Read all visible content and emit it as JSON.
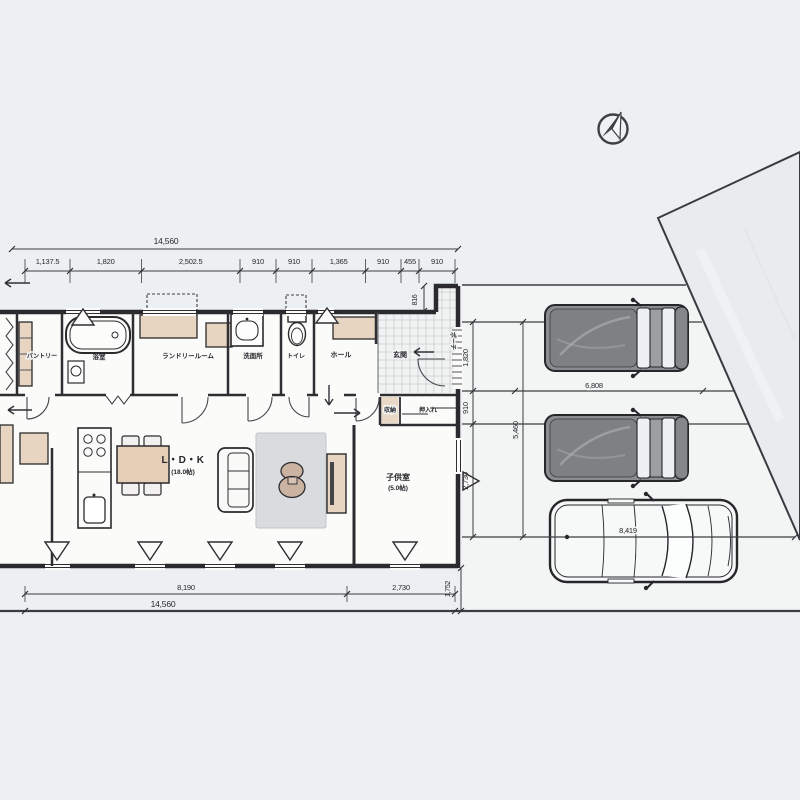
{
  "scene": {
    "type": "architectural-floor-plan",
    "style": "hand-drawn Japanese single-story house plan with parking lot, three vehicles and north compass",
    "colors": {
      "background": "#edf0f2",
      "floor": "#fbfbfa",
      "wall_ink": "#2a2a2f",
      "accent_beige": "#e7d5c2",
      "rug_gray": "#d9dcdf",
      "van_gray": "#8a8d90",
      "neighbor_lot": "#e9ecee"
    }
  },
  "rooms": {
    "pantry": "パントリー",
    "bath": "浴室",
    "laundry": "ランドリールーム",
    "washroom": "洗面所",
    "toilet": "トイレ",
    "hall": "ホール",
    "entrance": "玄関",
    "porch": "ポーチ",
    "closet": "収納",
    "oshiire": "押入れ",
    "ldk_label": "L・D・K",
    "ldk_size": "(18.0帖)",
    "kids_label": "子供室",
    "kids_size": "(5.0帖)"
  },
  "dims": {
    "top_total": "14,560",
    "seg1": "1,137.5",
    "seg2": "1,820",
    "seg3": "2,502.5",
    "seg4": "910",
    "seg5": "910",
    "seg6": "1,365",
    "seg7": "910",
    "seg8": "455",
    "seg9": "910",
    "porch_depth": "816",
    "right_seg1": "1,820",
    "right_seg2": "910",
    "right_seg3": "2,730",
    "right_total": "5,460",
    "lower_right": "1,752",
    "bottom_seg1": "8,190",
    "bottom_seg2": "2,730",
    "bottom_total": "14,560",
    "van_length": "6,808",
    "car_length": "8,419"
  }
}
